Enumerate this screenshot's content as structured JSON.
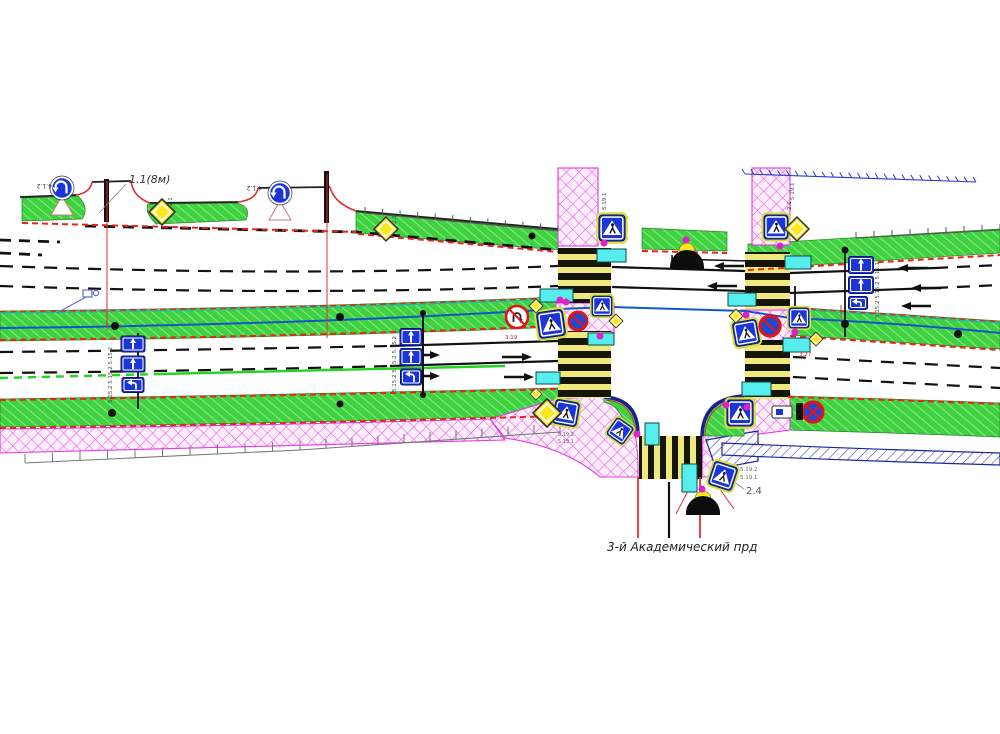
{
  "drawing": {
    "title": "traffic-management-plan",
    "street_label": "3-й Академический прд",
    "colors": {
      "grass": "#3fd13f",
      "sidewalk_pink": "#fdeefb",
      "hatch_magenta": "#ef52ea",
      "wall_blue": "#2a3bd0",
      "sign_blue": "#1b35d6",
      "board_cyan": "#55eded",
      "curb_red": "#ea2418",
      "zebra_bar": "#15150a",
      "zebra_gap": "#efe87c",
      "diamond_yellow": "#ffe819",
      "post_magenta": "#e020c8",
      "comm_blue": "#1456c8",
      "marking_green": "#23d423",
      "dome_black": "#0c0c0c"
    },
    "labels": [
      {
        "t": "1.1(8м)",
        "x": 129,
        "y": 183,
        "s": 11,
        "c": "#333",
        "i": 1,
        "name": "marking-note"
      },
      {
        "t": "4.1.2",
        "x": 52,
        "y": 184,
        "s": 6,
        "c": "#333",
        "r": 180,
        "name": "sign-code-4-1-2"
      },
      {
        "t": "4.1.2",
        "x": 262,
        "y": 186,
        "s": 6,
        "c": "#333",
        "r": 180,
        "name": "sign-code-4-1-2"
      },
      {
        "t": "2.1",
        "x": 172,
        "y": 206,
        "s": 5.5,
        "c": "#444",
        "r": -90,
        "name": "sign-code-2-1"
      },
      {
        "t": "2.1",
        "x": 396,
        "y": 224,
        "s": 5.5,
        "c": "#444",
        "r": -90,
        "name": "sign-code-2-1"
      },
      {
        "t": "2.1",
        "x": 791,
        "y": 210,
        "s": 5.5,
        "c": "#444",
        "r": -90,
        "name": "sign-code-2-1"
      },
      {
        "t": "5.19.1",
        "x": 606,
        "y": 210,
        "s": 5.5,
        "c": "#444",
        "r": -90,
        "name": "sign-code-5-19-1"
      },
      {
        "t": "5.19.1",
        "x": 794,
        "y": 200,
        "s": 5.5,
        "c": "#444",
        "r": -90,
        "name": "sign-code-5-19-1"
      },
      {
        "t": "5.15.2 5.15.2 5.15.2",
        "x": 112,
        "y": 403,
        "s": 5.5,
        "c": "#444",
        "r": -90,
        "name": "sign-codes-5-15-2"
      },
      {
        "t": "5.15.2 5.15.2 5.15.2",
        "x": 396,
        "y": 392,
        "s": 5.5,
        "c": "#444",
        "r": -90,
        "name": "sign-codes-5-15-2"
      },
      {
        "t": "5.15.2 5.15.2 5.15.1",
        "x": 879,
        "y": 318,
        "s": 5.5,
        "c": "#444",
        "r": -90,
        "name": "sign-codes-5-15-x"
      },
      {
        "t": "5.19.2",
        "x": 558,
        "y": 436,
        "s": 5,
        "c": "#666",
        "name": "sign-code-5-19-2"
      },
      {
        "t": "5.19.1",
        "x": 558,
        "y": 443,
        "s": 5,
        "c": "#666",
        "name": "sign-code-5-19-1"
      },
      {
        "t": "5.19.2",
        "x": 740,
        "y": 471,
        "s": 5.5,
        "c": "#666",
        "name": "sign-code-5-19-2"
      },
      {
        "t": "5.19.1",
        "x": 740,
        "y": 479,
        "s": 5.5,
        "c": "#666",
        "name": "sign-code-5-19-1"
      },
      {
        "t": "2.4",
        "x": 746,
        "y": 494,
        "s": 10,
        "c": "#555",
        "name": "sign-code-2-4"
      },
      {
        "t": "3.19",
        "x": 505,
        "y": 339,
        "s": 5.5,
        "c": "#d81414",
        "name": "sign-code-3-19"
      },
      {
        "t": "3.27",
        "x": 799,
        "y": 356,
        "s": 5.5,
        "c": "#d81414",
        "name": "sign-code-3-27"
      },
      {
        "t": "3-й Академический прд",
        "x": 607,
        "y": 551,
        "s": 12,
        "c": "#222",
        "i": 1,
        "name": "street-name"
      }
    ],
    "elements": {
      "pedestrian_signs": [
        [
          612,
          228,
          26,
          0
        ],
        [
          551,
          324,
          26,
          -8
        ],
        [
          602,
          306,
          20,
          0
        ],
        [
          566,
          413,
          24,
          10
        ],
        [
          620,
          431,
          20,
          35
        ],
        [
          746,
          333,
          24,
          -10
        ],
        [
          799,
          318,
          20,
          0
        ],
        [
          776,
          227,
          24,
          0
        ],
        [
          740,
          413,
          26,
          0
        ],
        [
          723,
          476,
          24,
          18
        ]
      ],
      "diamonds_big": [
        [
          162,
          212,
          13
        ],
        [
          386,
          229,
          12
        ],
        [
          797,
          229,
          12
        ],
        [
          547,
          413,
          14
        ]
      ],
      "diamonds_small": [
        [
          536,
          306,
          7
        ],
        [
          616,
          321,
          7
        ],
        [
          736,
          316,
          7
        ],
        [
          816,
          339,
          7
        ],
        [
          536,
          394,
          6
        ]
      ],
      "turn_signs": [
        [
          62,
          188
        ],
        [
          280,
          193
        ]
      ],
      "no_uturn_signs": [
        [
          517,
          317,
          11
        ]
      ],
      "no_stop_signs": [
        [
          578,
          321,
          9,
          "slash"
        ],
        [
          770,
          326,
          10,
          "slash"
        ],
        [
          813,
          412,
          10,
          "x"
        ]
      ],
      "lane_signs": [
        [
          133,
          344,
          24,
          16,
          "up"
        ],
        [
          133,
          364,
          24,
          16,
          "up"
        ],
        [
          133,
          385,
          22,
          15,
          "hook"
        ],
        [
          411,
          337,
          22,
          17,
          "up"
        ],
        [
          411,
          357,
          22,
          17,
          "up"
        ],
        [
          411,
          377,
          21,
          16,
          "hook"
        ],
        [
          861,
          265,
          25,
          17,
          "up"
        ],
        [
          861,
          285,
          25,
          17,
          "up"
        ],
        [
          858,
          303,
          19,
          13,
          "hook"
        ]
      ],
      "cyan_boards": [
        [
          540,
          289,
          33,
          13
        ],
        [
          597,
          249,
          29,
          13
        ],
        [
          588,
          333,
          26,
          12
        ],
        [
          536,
          372,
          24,
          12
        ],
        [
          645,
          423,
          14,
          22
        ],
        [
          682,
          464,
          15,
          28
        ],
        [
          742,
          382,
          29,
          14
        ],
        [
          785,
          256,
          26,
          13
        ],
        [
          728,
          293,
          28,
          13
        ],
        [
          783,
          338,
          27,
          14
        ]
      ],
      "magenta_dots": [
        [
          604,
          243
        ],
        [
          560,
          300
        ],
        [
          600,
          336
        ],
        [
          637,
          434
        ],
        [
          726,
          405
        ],
        [
          746,
          315
        ],
        [
          795,
          332
        ],
        [
          780,
          246
        ],
        [
          686,
          240
        ],
        [
          702,
          489
        ],
        [
          747,
          407
        ],
        [
          566,
          302
        ]
      ],
      "trees": [
        [
          115,
          326,
          4
        ],
        [
          340,
          317,
          4
        ],
        [
          532,
          236,
          3.5
        ],
        [
          845,
          250,
          3.5
        ],
        [
          845,
          324,
          4
        ],
        [
          958,
          334,
          4
        ],
        [
          112,
          413,
          4
        ],
        [
          340,
          404,
          3.5
        ],
        [
          423,
          313,
          3
        ],
        [
          423,
          395,
          3
        ]
      ],
      "poles": [
        [
          138,
          333,
          138,
          409,
          1.8
        ],
        [
          423,
          314,
          423,
          394,
          2
        ],
        [
          845,
          251,
          845,
          337,
          1.8
        ],
        [
          795,
          286,
          795,
          308,
          1.8
        ],
        [
          672,
          255,
          672,
          264,
          1.5
        ],
        [
          672,
          259,
          788,
          262,
          1.5
        ]
      ],
      "bay_posts": [
        [
          104,
          179,
          5,
          43
        ],
        [
          324,
          171,
          5,
          52
        ]
      ],
      "red_lines": [
        [
          107,
          181,
          107,
          330
        ],
        [
          327,
          174,
          327,
          338
        ],
        [
          841,
          305,
          841,
          318
        ],
        [
          688,
          491,
          676,
          514
        ],
        [
          717,
          485,
          734,
          509
        ]
      ],
      "grey_leaders": [
        [
          126,
          184,
          99,
          213
        ],
        [
          734,
          482,
          744,
          489
        ]
      ],
      "camera_leader": [
        [
          86,
          297,
          57,
          313
        ]
      ],
      "arrows_left": [
        [
          714,
          266
        ],
        [
          707,
          286
        ],
        [
          898,
          268
        ],
        [
          911,
          288
        ],
        [
          901,
          306
        ]
      ],
      "arrows_right": [
        [
          440,
          355
        ],
        [
          440,
          376
        ],
        [
          532,
          357
        ],
        [
          534,
          377
        ]
      ],
      "domes": [
        [
          687,
          267,
          17
        ],
        [
          703,
          513,
          17
        ]
      ],
      "yellow_semis": [
        [
          687,
          251,
          8
        ],
        [
          703,
          499,
          8
        ]
      ],
      "fences": [
        {
          "pts": [
            [
              365,
              213
            ],
            [
              558,
              231
            ]
          ],
          "n": 11,
          "len": 6,
          "c": "#555",
          "diag": 0
        },
        {
          "pts": [
            [
              856,
              238
            ],
            [
              1000,
              230
            ]
          ],
          "n": 8,
          "len": 6,
          "c": "#555",
          "diag": 0
        },
        {
          "pts": [
            [
              25,
              463
            ],
            [
              300,
              450
            ],
            [
              560,
              432
            ]
          ],
          "n": 10,
          "len": 9,
          "c": "#777",
          "diag": 0
        },
        {
          "pts": [
            [
              745,
              174
            ],
            [
              976,
              182
            ]
          ],
          "n": 26,
          "len": 5,
          "c": "#2a3bd0",
          "diag": 1
        }
      ]
    }
  }
}
